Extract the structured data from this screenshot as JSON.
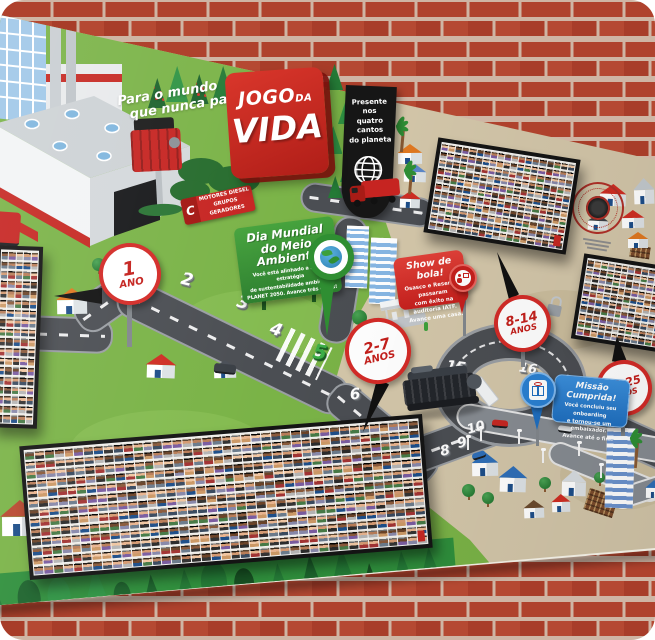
{
  "colors": {
    "brick": "#b5452f",
    "mortar": "#d7c2b0",
    "lawn": "#7ab347",
    "sand": "#d3c6a9",
    "logo_red": "#c8271f",
    "board_green": "#379a36",
    "event_red": "#d02f28",
    "event_blue": "#2a80d2",
    "banner_black": "#161616",
    "road_gray": "#4b4e53"
  },
  "mural": {
    "logo_sign": {
      "word1": "JOGO",
      "word2": "DA",
      "word3": "VIDA"
    },
    "tagline": {
      "line1": "Para o mundo",
      "line2": "que nunca para"
    },
    "black_banner": {
      "line1": "Presente nos",
      "line2": "quatro cantos",
      "line3": "do planeta"
    },
    "road_sign": {
      "logo_letter": "C",
      "line1": "MOTORES DIESEL",
      "line2": "GRUPOS GERADORES"
    },
    "billboard": {
      "title1": "Dia Mundial",
      "title2": "do Meio Ambiente",
      "body1": "Você está alinhado a nossa estratégia",
      "body2": "de sustentabilidade ambiental",
      "body3": "PLANET 2050. Avance três casas!"
    },
    "event_sign_red": {
      "title": "Show de bola!",
      "body1": "Osasco e Resende passaram",
      "body2": "com êxito na auditoria IATF.",
      "body3": "Avance uma casa."
    },
    "event_sign_blue": {
      "title": "Missão Cumprida!",
      "body1": "Você concluiu seu onboarding",
      "body2": "e tornou-se um embaixador.",
      "body3": "Avance até o fim!"
    },
    "milestones": [
      {
        "top": "1",
        "bottom": "ANO"
      },
      {
        "top": "2-7",
        "bottom": "ANOS"
      },
      {
        "top": "8-14",
        "bottom": "ANOS"
      },
      {
        "top": "15-25",
        "bottom": "ANOS"
      }
    ],
    "board_numbers": [
      {
        "n": "2",
        "x": 187,
        "y": 280,
        "rot": 14,
        "size": 17
      },
      {
        "n": "3",
        "x": 243,
        "y": 303,
        "rot": 16,
        "size": 17
      },
      {
        "n": "4",
        "x": 276,
        "y": 330,
        "rot": 18,
        "size": 17
      },
      {
        "n": "5",
        "x": 320,
        "y": 352,
        "rot": 10,
        "size": 20,
        "green": true
      },
      {
        "n": "6",
        "x": 355,
        "y": 394,
        "rot": -6,
        "size": 15
      },
      {
        "n": "7",
        "x": 419,
        "y": 448,
        "rot": -12,
        "size": 14
      },
      {
        "n": "8",
        "x": 445,
        "y": 451,
        "rot": -12,
        "size": 14
      },
      {
        "n": "9",
        "x": 462,
        "y": 443,
        "rot": -14,
        "size": 14
      },
      {
        "n": "10",
        "x": 476,
        "y": 428,
        "rot": -16,
        "size": 13
      },
      {
        "n": "13",
        "x": 526,
        "y": 340,
        "rot": 10,
        "size": 13
      },
      {
        "n": "15",
        "x": 456,
        "y": 367,
        "rot": 8,
        "size": 14
      },
      {
        "n": "16",
        "x": 528,
        "y": 369,
        "rot": 8,
        "size": 13
      },
      {
        "n": "19",
        "x": 580,
        "y": 391,
        "rot": 14,
        "size": 13
      },
      {
        "n": "20",
        "x": 609,
        "y": 404,
        "rot": 16,
        "size": 13
      }
    ]
  }
}
